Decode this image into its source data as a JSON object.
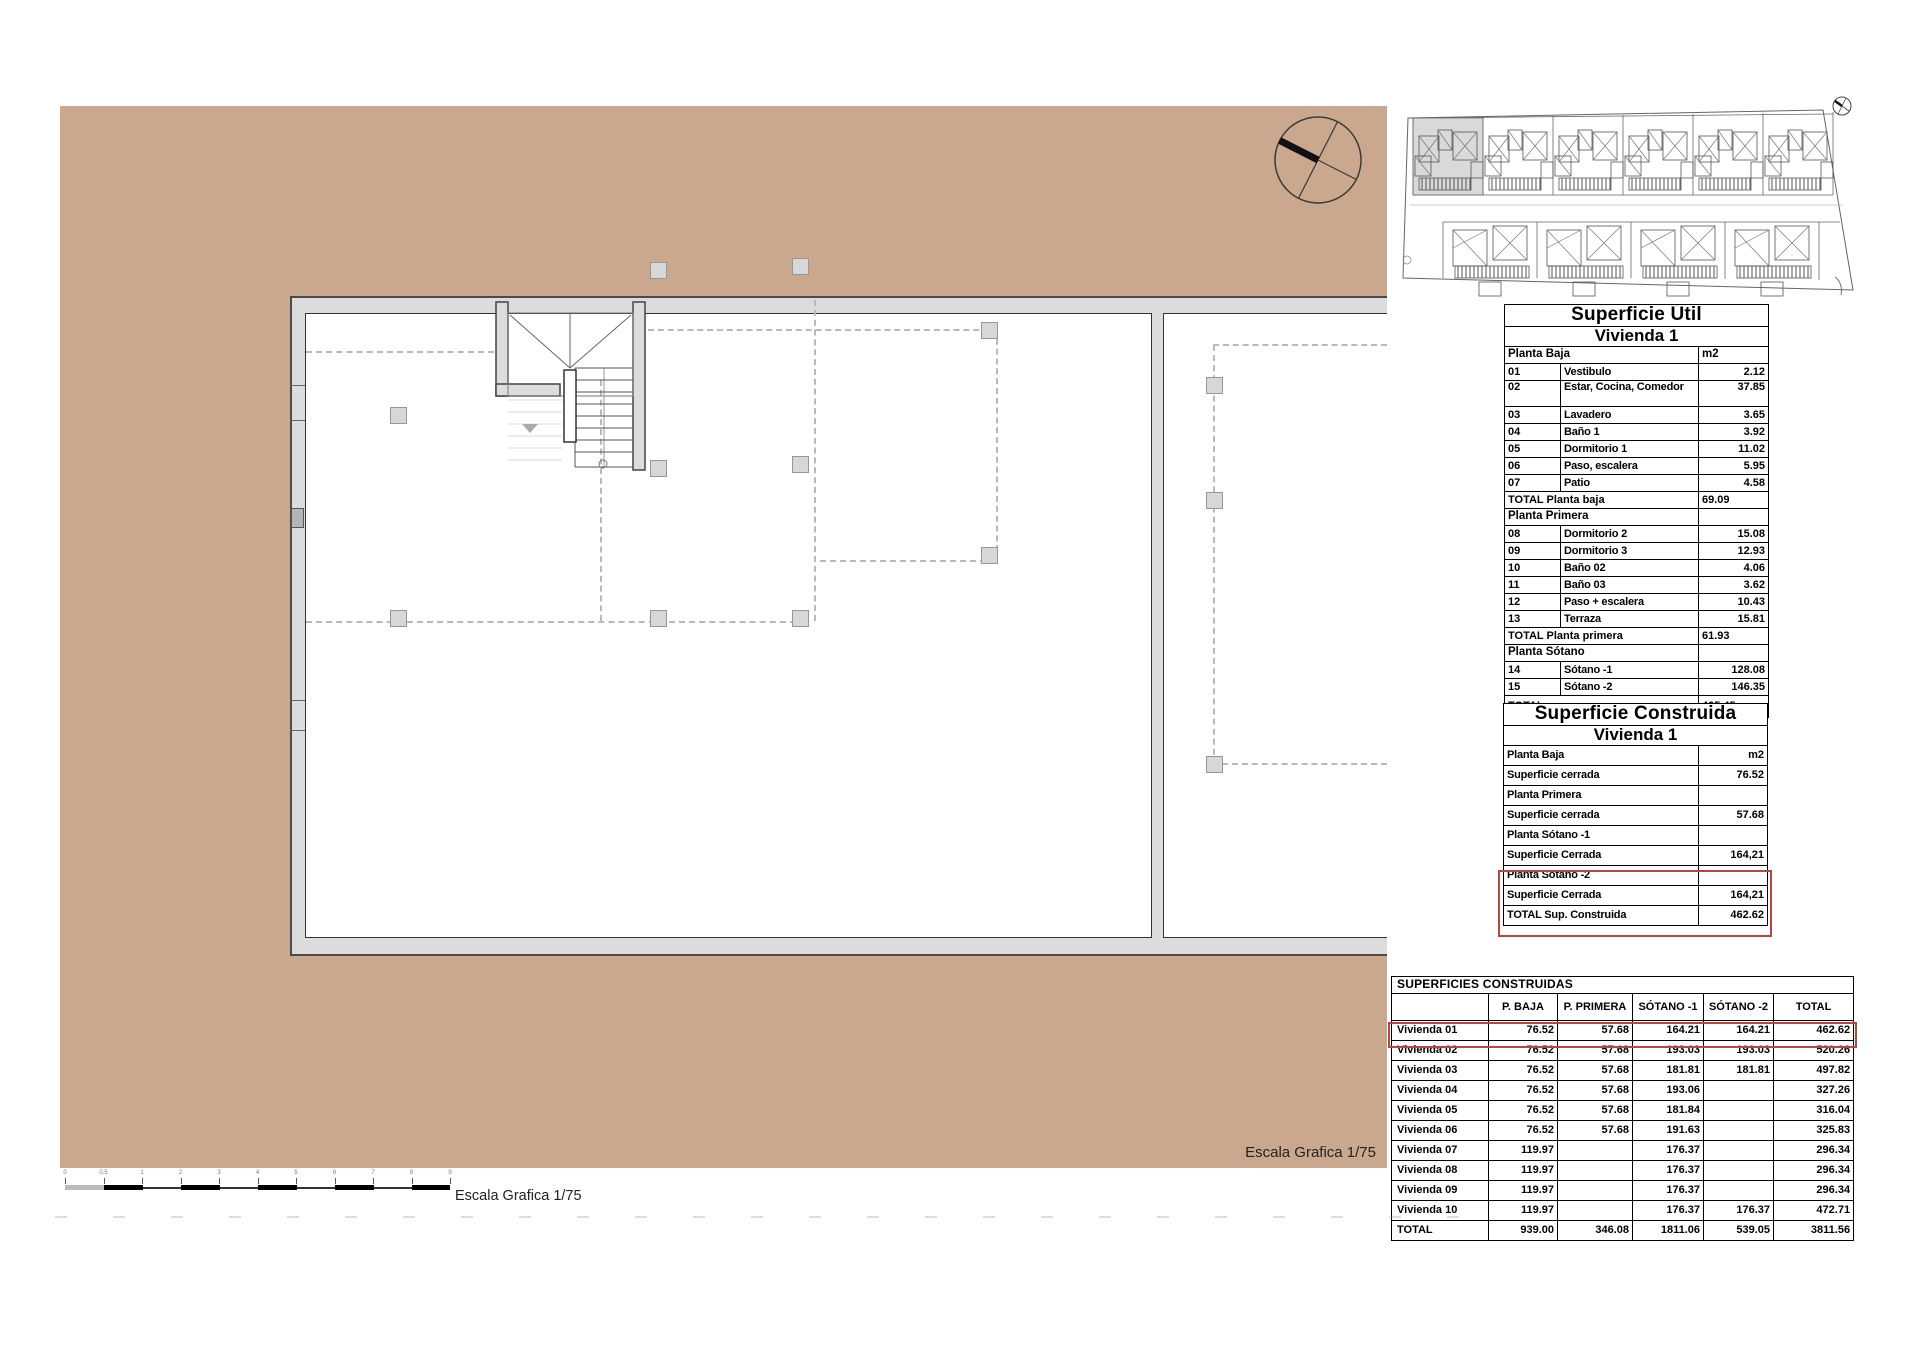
{
  "plan": {
    "escala_label_inner": "Escala Grafica 1/75",
    "escala_label_bar": "Escala Grafica 1/75"
  },
  "scale_bar": {
    "ticks": [
      "0",
      "0.5",
      "1",
      "2",
      "3",
      "4",
      "5",
      "6",
      "7",
      "8",
      "9"
    ]
  },
  "superficie_util": {
    "title": "Superficie Útil",
    "vivienda": "Vivienda 1",
    "unit": "m2",
    "planta_baja_label": "Planta Baja",
    "baja_rows": [
      {
        "num": "01",
        "name": "Vestibulo",
        "val": "2.12"
      },
      {
        "num": "02",
        "name": "Estar, Cocina, Comedor",
        "val": "37.85"
      },
      {
        "num": "03",
        "name": "Lavadero",
        "val": "3.65"
      },
      {
        "num": "04",
        "name": "Baño 1",
        "val": "3.92"
      },
      {
        "num": "05",
        "name": "Dormitorio 1",
        "val": "11.02"
      },
      {
        "num": "06",
        "name": "Paso, escalera",
        "val": "5.95"
      },
      {
        "num": "07",
        "name": "Patio",
        "val": "4.58"
      }
    ],
    "total_baja_label": "TOTAL Planta baja",
    "total_baja": "69.09",
    "planta_primera_label": "Planta Primera",
    "primera_rows": [
      {
        "num": "08",
        "name": "Dormitorio 2",
        "val": "15.08"
      },
      {
        "num": "09",
        "name": "Dormitorio 3",
        "val": "12.93"
      },
      {
        "num": "10",
        "name": "Baño 02",
        "val": "4.06"
      },
      {
        "num": "11",
        "name": "Baño 03",
        "val": "3.62"
      },
      {
        "num": "12",
        "name": "Paso + escalera",
        "val": "10.43"
      },
      {
        "num": "13",
        "name": "Terraza",
        "val": "15.81"
      }
    ],
    "total_primera_label": "TOTAL Planta primera",
    "total_primera": "61.93",
    "planta_sotano_label": "Planta Sótano",
    "sotano_rows": [
      {
        "num": "14",
        "name": "Sótano -1",
        "val": "128.08"
      },
      {
        "num": "15",
        "name": "Sótano -2",
        "val": "146.35"
      }
    ],
    "total_label": "TOTAL",
    "total": "405.45"
  },
  "superficie_construida": {
    "title": "Superficie Construida",
    "vivienda": "Vivienda 1",
    "rows": [
      {
        "label": "Planta Baja",
        "val": "m2",
        "highlighted": false
      },
      {
        "label": "Superficie cerrada",
        "val": "76.52",
        "highlighted": false
      },
      {
        "label": "Planta Primera",
        "val": "",
        "highlighted": false
      },
      {
        "label": "Superficie cerrada",
        "val": "57.68",
        "highlighted": false
      },
      {
        "label": "Planta Sótano -1",
        "val": "",
        "highlighted": false
      },
      {
        "label": "Superficie Cerrada",
        "val": "164,21",
        "highlighted": false
      },
      {
        "label": "Planta Sótano -2",
        "val": "",
        "highlighted": true
      },
      {
        "label": "Superficie Cerrada",
        "val": "164,21",
        "highlighted": true
      },
      {
        "label": "TOTAL Sup. Construida",
        "val": "462.62",
        "highlighted": true
      }
    ]
  },
  "superficies_construidas": {
    "title": "SUPERFICIES CONSTRUIDAS",
    "columns": [
      "",
      "P. BAJA",
      "P. PRIMERA",
      "SÓTANO -1",
      "SÓTANO -2",
      "TOTAL"
    ],
    "rows": [
      [
        "Vivienda 01",
        "76.52",
        "57.68",
        "164.21",
        "164.21",
        "462.62"
      ],
      [
        "Vivienda 02",
        "76.52",
        "57.68",
        "193.03",
        "193.03",
        "520.26"
      ],
      [
        "Vivienda 03",
        "76.52",
        "57.68",
        "181.81",
        "181.81",
        "497.82"
      ],
      [
        "Vivienda 04",
        "76.52",
        "57.68",
        "193.06",
        "",
        "327.26"
      ],
      [
        "Vivienda 05",
        "76.52",
        "57.68",
        "181.84",
        "",
        "316.04"
      ],
      [
        "Vivienda 06",
        "76.52",
        "57.68",
        "191.63",
        "",
        "325.83"
      ],
      [
        "Vivienda 07",
        "119.97",
        "",
        "176.37",
        "",
        "296.34"
      ],
      [
        "Vivienda 08",
        "119.97",
        "",
        "176.37",
        "",
        "296.34"
      ],
      [
        "Vivienda 09",
        "119.97",
        "",
        "176.37",
        "",
        "296.34"
      ],
      [
        "Vivienda 10",
        "119.97",
        "",
        "176.37",
        "176.37",
        "472.71"
      ],
      [
        "TOTAL",
        "939.00",
        "346.08",
        "1811.06",
        "539.05",
        "3811.56"
      ]
    ]
  },
  "colors": {
    "tan_background": "#c9a88d",
    "wall_gray": "#dcdcdc",
    "highlight_red": "#b8463c"
  }
}
